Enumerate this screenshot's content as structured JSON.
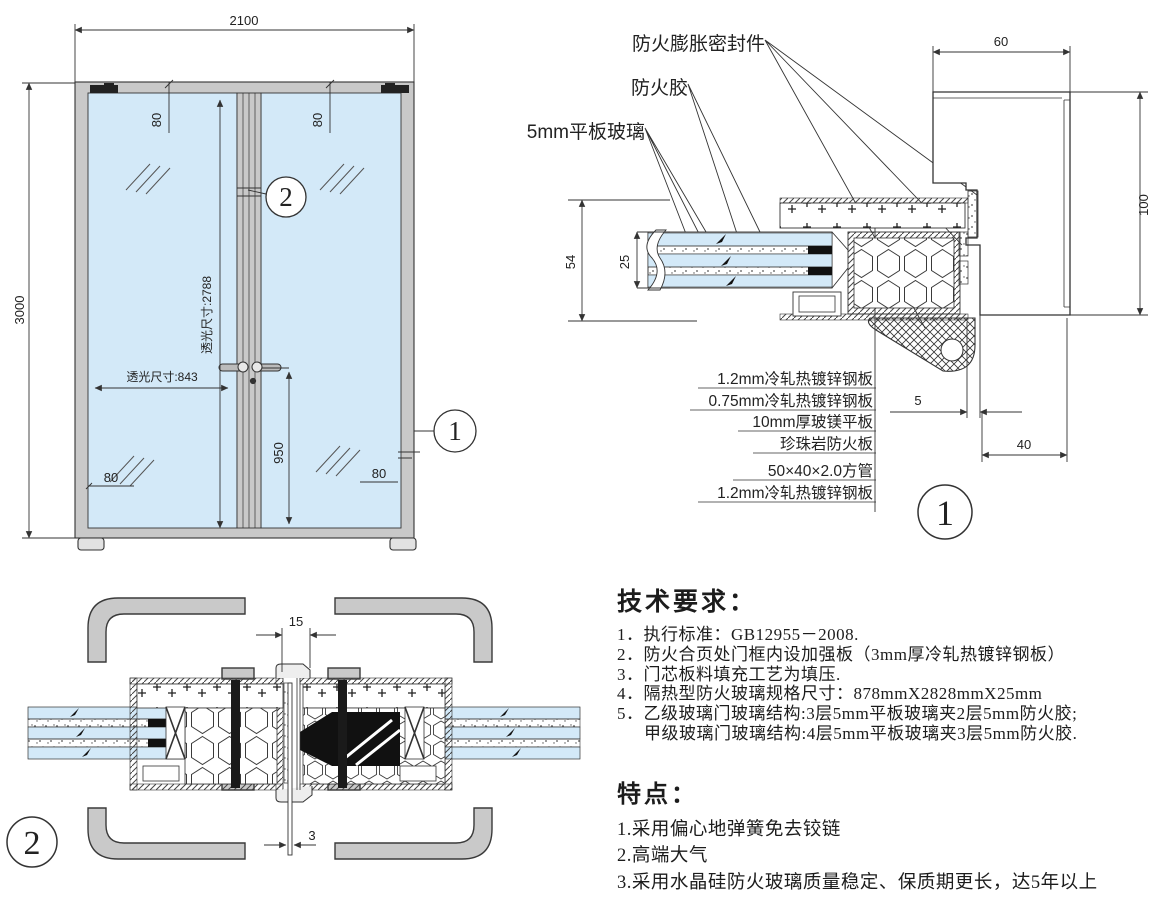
{
  "colors": {
    "glass_blue": "#d3e9f8",
    "metal_gray": "#c9c9c9",
    "line_dark": "#333333"
  },
  "elevation": {
    "dim_width": "2100",
    "dim_height": "3000",
    "dim_clear_height": "透光尺寸:2788",
    "dim_clear_width": "透光尺寸:843",
    "dim_handle_height": "950",
    "dim_top_left": "80",
    "dim_top_right": "80",
    "dim_bottom_left": "80",
    "dim_bottom_right": "80",
    "marker_detail1": "1",
    "marker_detail2": "2"
  },
  "detail1": {
    "callout_expansion_seal": "防火膨胀密封件",
    "callout_fire_glue": "防火胶",
    "callout_flat_glass": "5mm平板玻璃",
    "dim_frame_face": "60",
    "dim_frame_depth": "100",
    "dim_leaf_thickness": "54",
    "dim_glass_stack": "25",
    "dim_gap": "5",
    "dim_stop": "40",
    "materials": [
      "1.2mm冷轧热镀锌钢板",
      "0.75mm冷轧热镀锌钢板",
      "10mm厚玻镁平板",
      "珍珠岩防火板",
      "50×40×2.0方管",
      "1.2mm冷轧热镀锌钢板"
    ],
    "marker": "1"
  },
  "detail2": {
    "dim_meeting_gap": "15",
    "dim_bottom_clearance": "3",
    "marker": "2"
  },
  "notes": {
    "tech_title": "技术要求：",
    "tech_items": [
      "1．执行标准：GB12955－2008.",
      "2．防火合页处门框内设加强板（3mm厚冷轧热镀锌钢板）",
      "3．门芯板料填充工艺为填压.",
      "4．隔热型防火玻璃规格尺寸：878mmX2828mmX25mm",
      "5．乙级玻璃门玻璃结构:3层5mm平板玻璃夹2层5mm防火胶;",
      "甲级玻璃门玻璃结构:4层5mm平板玻璃夹3层5mm防火胶."
    ],
    "feature_title": "特点：",
    "feature_items": [
      "1.采用偏心地弹簧免去铰链",
      "2.高端大气",
      "3.采用水晶硅防火玻璃质量稳定、保质期更长，达5年以上"
    ]
  }
}
